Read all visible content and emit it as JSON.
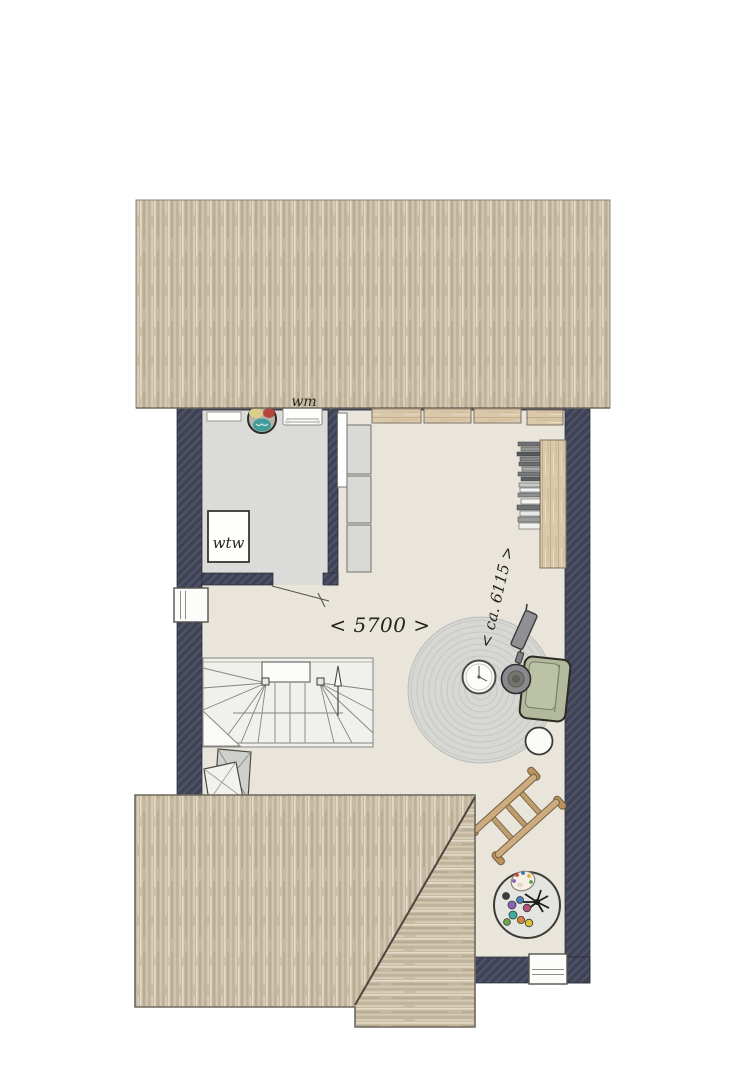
{
  "plan": {
    "title": "attic floor plan",
    "labels": {
      "washing_machine": "wm",
      "heat_recovery": "wtw"
    },
    "dimensions": {
      "width_mm": "< 5700 >",
      "depth_mm": "< ca. 6115 >"
    },
    "rooms": [
      "laundry-technical-room",
      "open-attic-space"
    ],
    "features": [
      "upper-roof-surface",
      "lower-roof-surface",
      "winder-staircase",
      "left-facade-window",
      "bottom-facade-window",
      "laundry-door-swing"
    ],
    "furniture": [
      "washing-machine",
      "laundry-basket",
      "wall-shelf",
      "heat-recovery-unit",
      "storage-cabinets",
      "wardrobe-cabinets",
      "bookshelf",
      "lounge-chair",
      "floor-lamp",
      "side-table",
      "pouf",
      "round-rug",
      "decor-ladder",
      "craft-table",
      "folded-drying-rack"
    ],
    "colors": {
      "wall": "#3f4254",
      "wall_hatch": "#4e5268",
      "floor_main": "#e9e5db",
      "floor_laundry": "#dbdbd9",
      "roof_base": "#c6b9a1",
      "roof_stripe_light": "#e3dbc9",
      "roof_stripe_dark": "#b9ac94",
      "wood": "#dac8aa",
      "chair_green": "#b2b99c",
      "rug_gray": "#d7d7d4",
      "ladder_wood": "#cdab7e",
      "accent_teal": "#3f9e9b",
      "accent_red": "#b5453c",
      "outline": "#6e685c"
    }
  }
}
